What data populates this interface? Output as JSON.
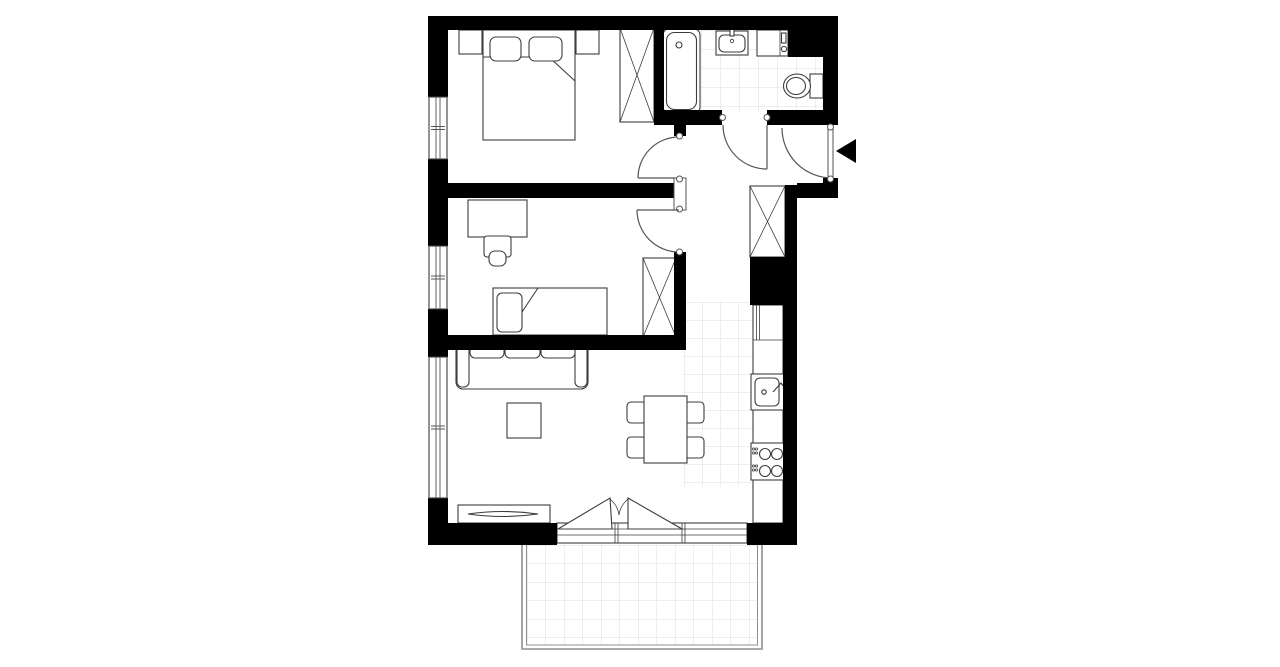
{
  "canvas": {
    "width": 1280,
    "height": 667,
    "background": "#ffffff"
  },
  "colors": {
    "wall": "#000000",
    "outline": "#3c3c3c",
    "door": "#555555",
    "tile": "#dcdcdc",
    "railing": "#8f8f8f",
    "bg": "#ffffff",
    "fix": "#ffffff"
  },
  "plan": {
    "label": "apartment floor plan",
    "rooms": [
      {
        "name": "bedroom-1",
        "furniture": [
          "double-bed",
          "pillow",
          "pillow",
          "nightstand",
          "nightstand",
          "wardrobe"
        ]
      },
      {
        "name": "bedroom-2",
        "furniture": [
          "desk",
          "desk-chair",
          "single-bed",
          "pillow",
          "wardrobe"
        ]
      },
      {
        "name": "bathroom",
        "furniture": [
          "bathtub",
          "washbasin",
          "washing-machine",
          "toilet"
        ],
        "floor": "tiled"
      },
      {
        "name": "hall",
        "furniture": [
          "wardrobe"
        ]
      },
      {
        "name": "living-room-with-kitchen",
        "furniture": [
          "sofa",
          "coffee-table",
          "tv-bench",
          "tv",
          "dining-table",
          "chair",
          "chair",
          "chair",
          "chair",
          "kitchen-counter",
          "fridge",
          "kitchen-sink",
          "stove"
        ],
        "kitchen_floor": "tiled"
      },
      {
        "name": "balcony",
        "floor": "tiled",
        "enclosure": "railing"
      }
    ],
    "openings": [
      {
        "name": "entrance-door",
        "marker": "black-triangle-arrow"
      },
      {
        "name": "bathroom-door"
      },
      {
        "name": "bedroom-1-door"
      },
      {
        "name": "bedroom-2-door"
      },
      {
        "name": "balcony-double-door"
      },
      {
        "name": "window",
        "count": 3,
        "wall": "left"
      }
    ]
  }
}
